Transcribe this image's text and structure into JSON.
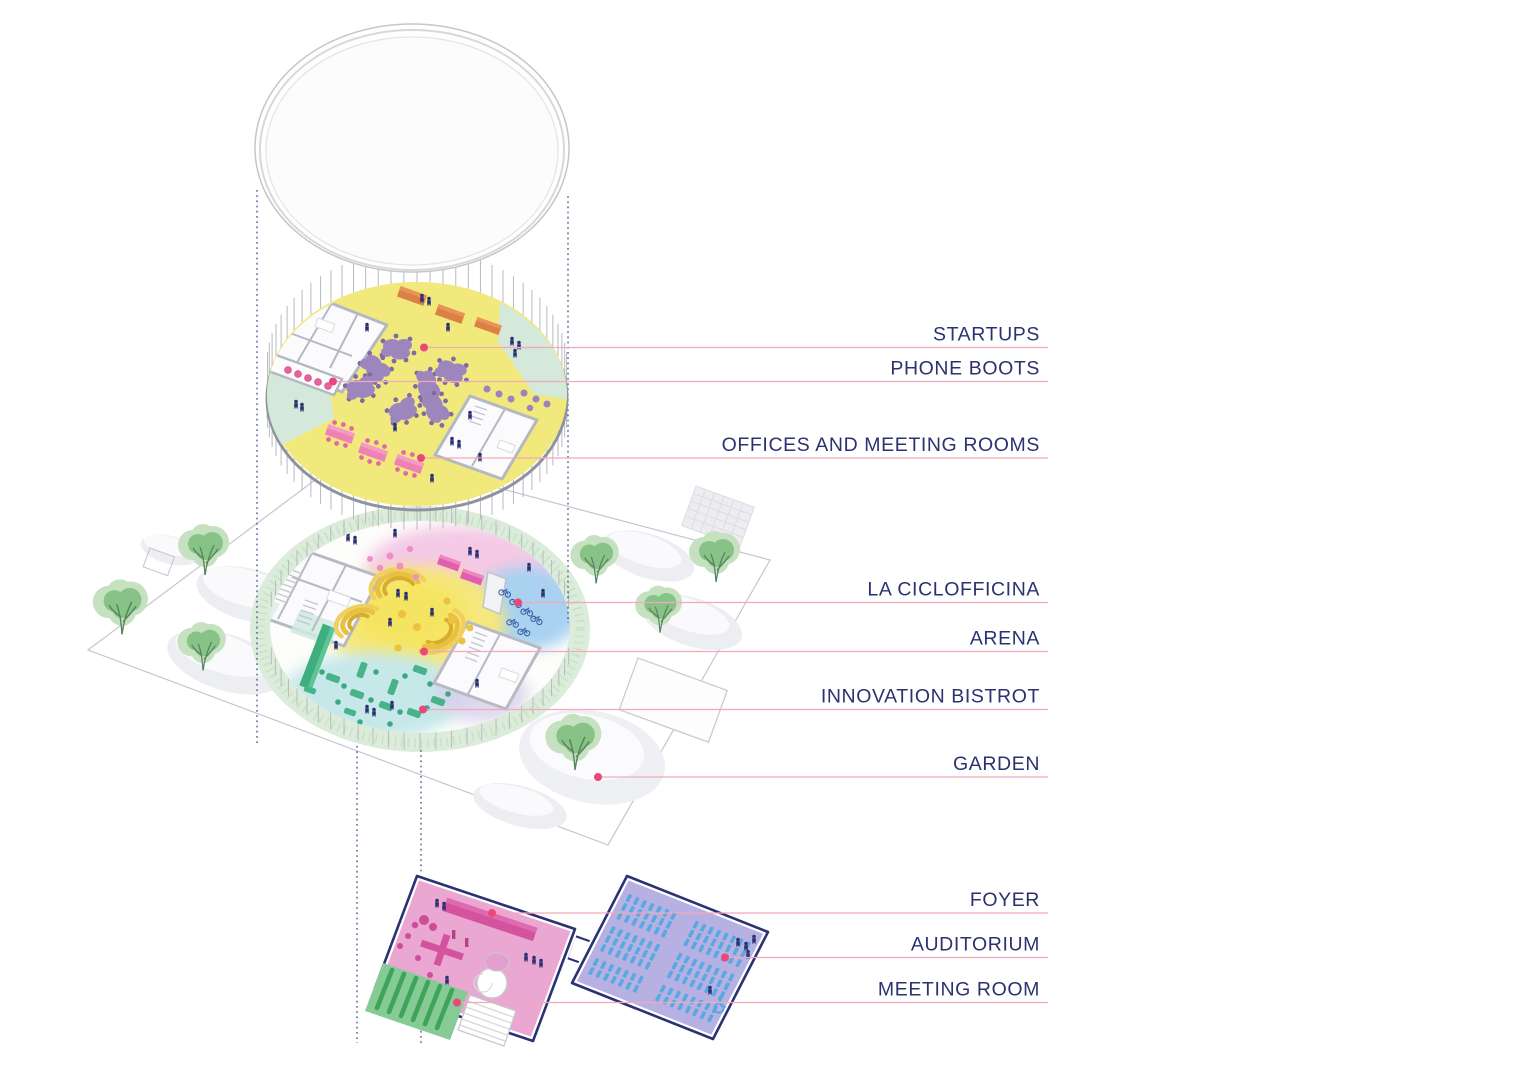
{
  "callouts": [
    {
      "label": "STARTUPS"
    },
    {
      "label": "PHONE BOOTS"
    },
    {
      "label": "OFFICES AND MEETING ROOMS"
    },
    {
      "label": "LA CICLOFFICINA"
    },
    {
      "label": "ARENA"
    },
    {
      "label": "INNOVATION BISTROT"
    },
    {
      "label": "GARDEN"
    },
    {
      "label": "FOYER"
    },
    {
      "label": "AUDITORIUM"
    },
    {
      "label": "MEETING ROOM"
    }
  ],
  "colors": {
    "label_text": "#2E3170",
    "leader_line": "#F2A9BE",
    "anchor_dot": "#E8487A",
    "projection_line": "#3C4386",
    "roof_disc": "#FEFEFE",
    "startups_floor_yellow": "#F2E97D",
    "terrace_green": "#D5E9DA",
    "desk_purple": "#9D85BD",
    "table_orange": "#DB8146",
    "table_pink": "#EE82B4",
    "garden_ring_green": "#DCECDB",
    "tree_green": "#87C387",
    "arena_gold": "#ECC33C",
    "bistrot_teal": "#46B389",
    "zone_pink": "#F4C9E6",
    "zone_blue": "#A9D2F0",
    "foyer_pink": "#E9A7D2",
    "furniture_magenta": "#D4539E",
    "meeting_room_green": "#86CB96",
    "auditorium_lavender": "#B6B1E2",
    "seat_blue": "#58A8E2",
    "outline_navy": "#2B3274",
    "people_navy": "#2B3173"
  }
}
